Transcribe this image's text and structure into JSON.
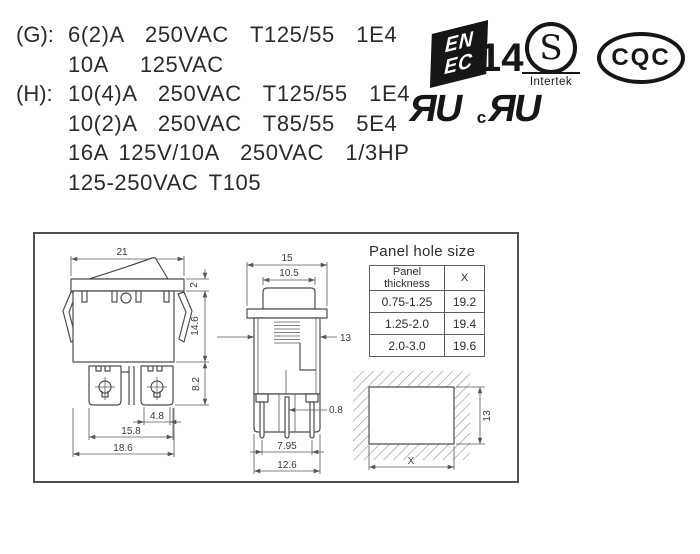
{
  "ratings": {
    "g_label": "(G):",
    "h_label": "(H):",
    "g_lines": [
      "6(2)A  250VAC  T125/55  1E4",
      "10A   125VAC"
    ],
    "h_lines": [
      "10(4)A  250VAC  T125/55  1E4",
      "10(2)A  250VAC  T85/55  5E4",
      "16A 125V/10A  250VAC  1/3HP",
      "125-250VAC T105"
    ]
  },
  "certs": {
    "enec": {
      "line1": "EN",
      "line2": "EC",
      "number": "14"
    },
    "intertek": {
      "letter": "S",
      "name": "Intertek"
    },
    "cqc": {
      "text": "CQC"
    },
    "ul": {
      "mark": "ЯU",
      "c_prefix": "c"
    }
  },
  "drawing": {
    "front": {
      "width": "21",
      "bezel_h": "2",
      "body_h": "14.6",
      "term_h": "8.2",
      "tab_w": "4.8",
      "lug_span": "15.8",
      "base_w": "18.6"
    },
    "side": {
      "width": "15",
      "actuator_w": "10.5",
      "body_w": "13",
      "pin_t": "0.8",
      "pin_span": "7.95",
      "base_w": "12.6"
    },
    "hole": {
      "width_label": "X",
      "height": "13"
    },
    "table": {
      "title": "Panel hole size",
      "col_thickness": "Panel thickness",
      "col_x": "X",
      "rows": [
        {
          "t": "0.75-1.25",
          "x": "19.2"
        },
        {
          "t": "1.25-2.0",
          "x": "19.4"
        },
        {
          "t": "2.0-3.0",
          "x": "19.6"
        }
      ]
    }
  },
  "colors": {
    "ink": "#161616",
    "line": "#4d4d4d"
  }
}
